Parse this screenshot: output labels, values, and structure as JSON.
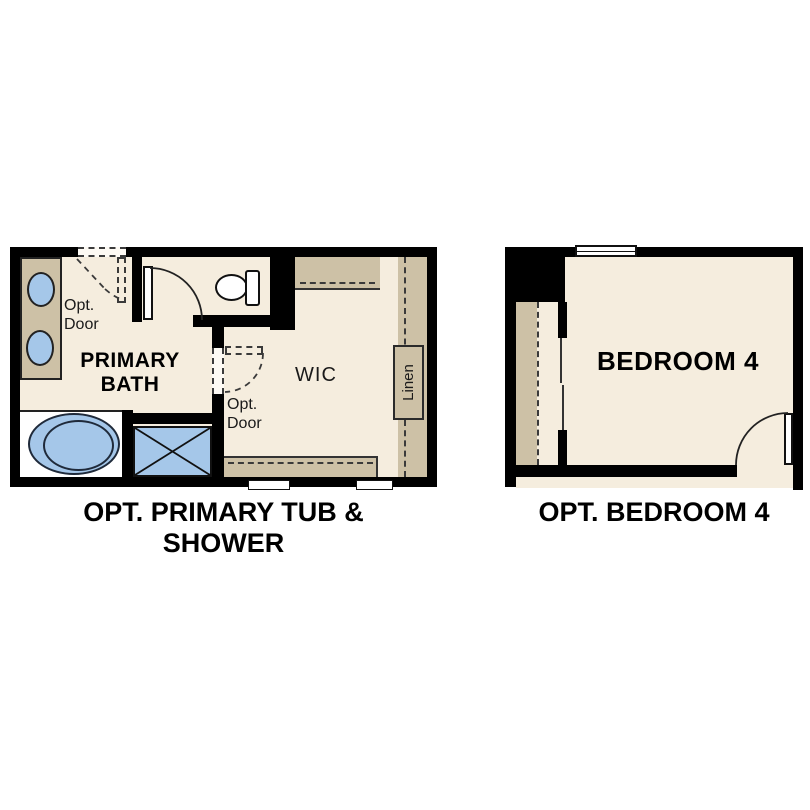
{
  "colors": {
    "wall": "#000000",
    "floor": "#f5edde",
    "shelf": "#cdc1a6",
    "fixture_blue": "#a5c7e9"
  },
  "plans": {
    "primary_bath": {
      "caption": [
        "OPT. PRIMARY TUB &",
        "SHOWER"
      ],
      "labels": {
        "bath_line1": "PRIMARY",
        "bath_line2": "BATH",
        "wic": "WIC",
        "linen": "Linen",
        "opt_door_top_line1": "Opt.",
        "opt_door_top_line2": "Door",
        "opt_door_wic_line1": "Opt.",
        "opt_door_wic_line2": "Door"
      }
    },
    "bedroom4": {
      "caption": "OPT. BEDROOM 4",
      "labels": {
        "room": "BEDROOM 4"
      }
    }
  }
}
